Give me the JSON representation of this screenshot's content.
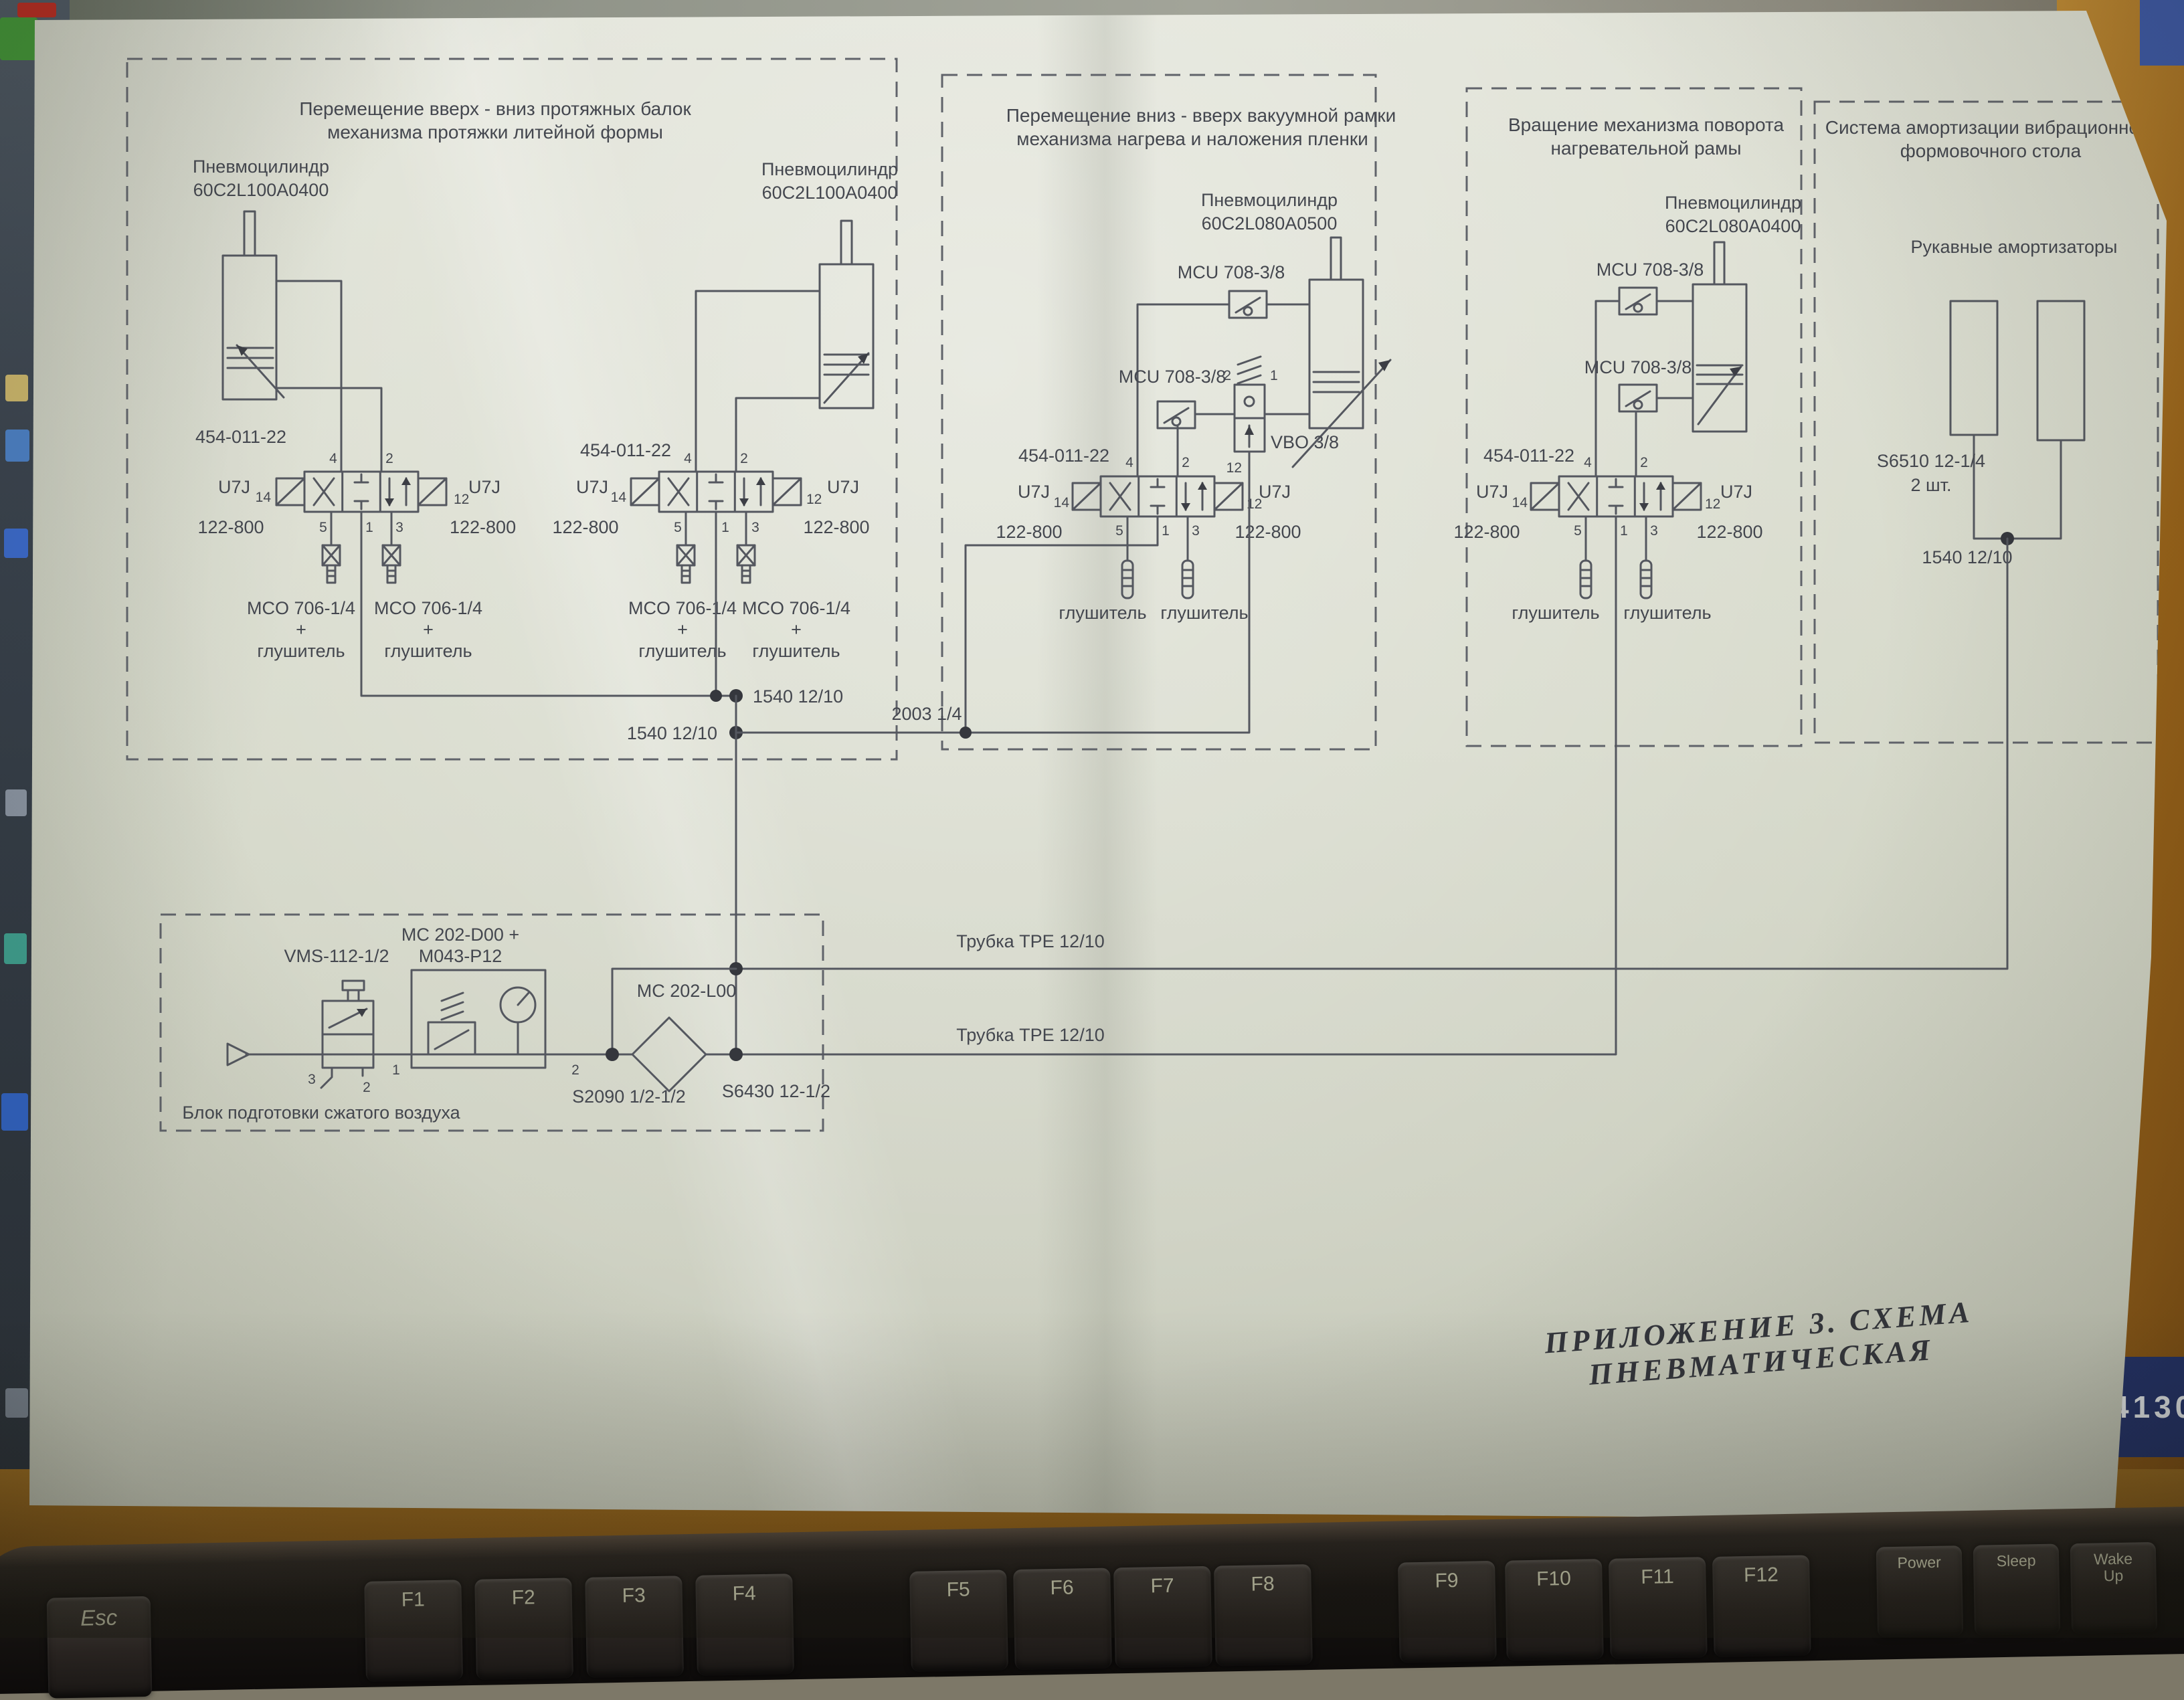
{
  "page": {
    "caption": "ПРИЛОЖЕНИЕ 3. СХЕМА ПНЕВМАТИЧЕСКАЯ",
    "monitor_code": "4130"
  },
  "shared": {
    "cylinder_label": "Пневмоцилиндр",
    "cyl_100": "60C2L100A0400",
    "cyl_080_0500": "60C2L080A0500",
    "cyl_080_0400": "60C2L080A0400",
    "valve_part": "454-011-22",
    "u7j": "U7J",
    "coil": "122-800",
    "mco": "MCO 706-1/4",
    "plus": "+",
    "muffler": "глушитель",
    "mcu": "MCU 708-3/8",
    "vbo": "VBO 3/8",
    "line_1540": "1540 12/10",
    "line_2003": "2003 1/4",
    "tube_tpe": "Трубка ТРЕ 12/10",
    "ports": {
      "p14": "14",
      "p12": "12",
      "p4": "4",
      "p2": "2",
      "p5": "5",
      "p1": "1",
      "p3": "3"
    }
  },
  "sections": {
    "s1": {
      "title1": "Перемещение вверх - вниз протяжных балок",
      "title2": "механизма протяжки литейной формы"
    },
    "s2": {
      "title1": "Перемещение вниз - вверх вакуумной рамки",
      "title2": "механизма нагрева и наложения пленки"
    },
    "s3": {
      "title1": "Вращение механизма поворота",
      "title2": "нагревательной рамы"
    },
    "s4": {
      "title1": "Система амортизации вибрационного",
      "title2": "формовочного стола",
      "dampers": "Рукавные амортизаторы",
      "part": "S6510 12-1/4",
      "qty": "2 шт."
    }
  },
  "airprep": {
    "title": "Блок подготовки сжатого воздуха",
    "vms": "VMS-112-1/2",
    "mc_d00_line1": "MC 202-D00 +",
    "mc_d00_line2": "M043-P12",
    "mc_l00": "MC 202-L00",
    "s2090": "S2090 1/2-1/2",
    "s6430": "S6430 12-1/2",
    "ports": {
      "p1": "1",
      "p2": "2",
      "p3": "3",
      "p2b": "2"
    }
  },
  "keyboard": {
    "keys": [
      {
        "label": "Esc"
      },
      {
        "label": "F1"
      },
      {
        "label": "F2"
      },
      {
        "label": "F3"
      },
      {
        "label": "F4"
      },
      {
        "label": "F5"
      },
      {
        "label": "F6"
      },
      {
        "label": "F7"
      },
      {
        "label": "F8"
      },
      {
        "label": "F9"
      },
      {
        "label": "F10"
      },
      {
        "label": "F11"
      },
      {
        "label": "F12"
      },
      {
        "label": "Power"
      },
      {
        "label": "Sleep"
      },
      {
        "label": "Wake\nUp"
      }
    ]
  }
}
